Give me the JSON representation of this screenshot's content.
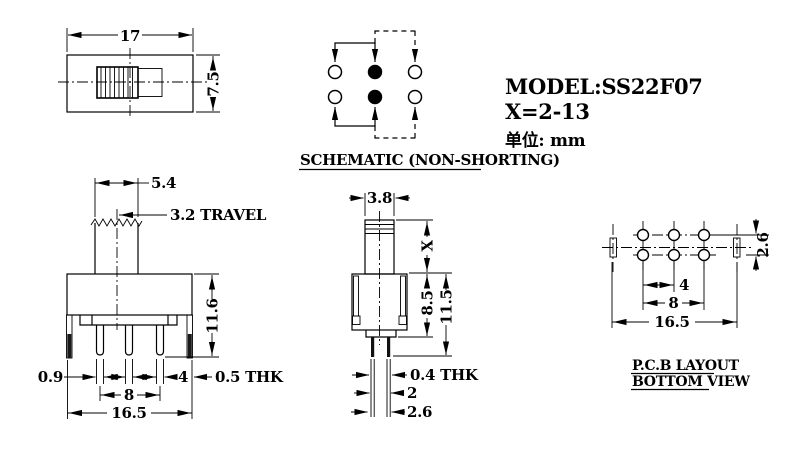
{
  "title_block": {
    "model": "MODEL:SS22F07",
    "x_range": "X=2-13",
    "unit": "单位: mm"
  },
  "top_view": {
    "dims": {
      "width": "17",
      "height": "7.5"
    }
  },
  "schematic": {
    "caption": "SCHEMATIC (NON-SHORTING)"
  },
  "front_view": {
    "dims": {
      "knob_width": "5.4",
      "travel": "3.2 TRAVEL",
      "height": "11.6",
      "pin_width": "0.9",
      "pin_pitch": "4",
      "tab_thk": "0.5 THK",
      "pin_span": "8",
      "width": "16.5"
    }
  },
  "side_view": {
    "dims": {
      "knob_width": "3.8",
      "knob_height": "X",
      "body_height": "8.5",
      "total_height": "11.5",
      "pin_thk": "0.4 THK",
      "pin_gap": "2",
      "pin_span": "2.6"
    }
  },
  "pcb_view": {
    "caption_line1": "P.C.B LAYOUT",
    "caption_line2": "BOTTOM VIEW",
    "dims": {
      "row_pitch": "2.6",
      "hole_pitch": "4",
      "hole_span": "8",
      "width": "16.5"
    }
  },
  "colors": {
    "line": "#000000",
    "background": "#ffffff"
  }
}
